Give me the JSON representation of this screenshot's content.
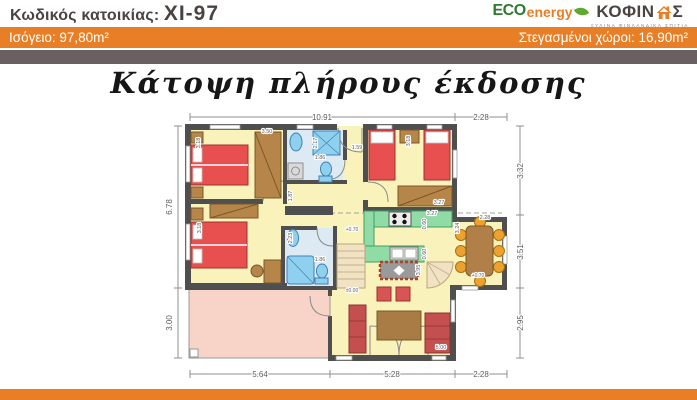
{
  "header": {
    "code_label": "Κωδικός κατοικίας:",
    "code_value": "XI-97",
    "logo": {
      "eco": "ECO",
      "energy": "energy",
      "brand_pre": "ΚΟΦΙΝ",
      "brand_post": "Σ",
      "tagline": "ΞΥΛΙΝΑ ΦΙΝΛΑΝΔΙΚΑ ΣΠΙΤΙΑ"
    },
    "area_bar": {
      "left": "Ισόγειο: 97,80m²",
      "right": "Στεγασμένοι χώροι: 16,90m²"
    }
  },
  "title": "Κάτοψη πλήρους έκδοσης",
  "colors": {
    "orange": "#E87E25",
    "dark_bar": "#6B6060",
    "wall": "#4F4F4F",
    "floor_yellow": "#F9F3BB",
    "bath_floor": "#DDE9F3",
    "terrace_pink": "#F7D3C8",
    "bed_red": "#E85050",
    "sofa_red": "#C44F4F",
    "wood_brown": "#B5854A",
    "counter_green": "#90DBA6",
    "fixture_blue": "#8FD0EF",
    "chair_orange": "#ECA22E",
    "stair_beige": "#F1E2C3"
  },
  "plan": {
    "labels": [
      {
        "t": "10.91",
        "x": 322,
        "y": 120,
        "s": 8
      },
      {
        "t": "2.28",
        "x": 481,
        "y": 120,
        "s": 8
      },
      {
        "t": "6.78",
        "x": 172,
        "y": 207,
        "r": -90,
        "s": 8
      },
      {
        "t": "3.00",
        "x": 172,
        "y": 323,
        "r": -90,
        "s": 8
      },
      {
        "t": "3.32",
        "x": 523,
        "y": 171,
        "r": -90,
        "s": 8
      },
      {
        "t": "3.51",
        "x": 523,
        "y": 252,
        "r": -90,
        "s": 8
      },
      {
        "t": "2.95",
        "x": 523,
        "y": 323,
        "r": -90,
        "s": 8
      },
      {
        "t": "5.64",
        "x": 260,
        "y": 377,
        "s": 8
      },
      {
        "t": "5.28",
        "x": 392,
        "y": 377,
        "s": 8
      },
      {
        "t": "2.28",
        "x": 481,
        "y": 377,
        "s": 8
      },
      {
        "t": "3.50",
        "x": 267,
        "y": 133
      },
      {
        "t": "3.18",
        "x": 200,
        "y": 143,
        "r": -90
      },
      {
        "t": "2.17",
        "x": 317,
        "y": 143,
        "r": -90
      },
      {
        "t": "1.86",
        "x": 320,
        "y": 159
      },
      {
        "t": "1.59",
        "x": 357,
        "y": 149
      },
      {
        "t": "3.18",
        "x": 410,
        "y": 141,
        "r": -90
      },
      {
        "t": "3.27",
        "x": 439,
        "y": 204
      },
      {
        "t": "1.87",
        "x": 292,
        "y": 196,
        "r": -90
      },
      {
        "t": "3.18",
        "x": 201,
        "y": 228,
        "r": -90
      },
      {
        "t": "2.23",
        "x": 292,
        "y": 238,
        "r": -90
      },
      {
        "t": "1.86",
        "x": 320,
        "y": 261
      },
      {
        "t": "3.27",
        "x": 432,
        "y": 215
      },
      {
        "t": "0.60",
        "x": 426,
        "y": 224,
        "r": -90
      },
      {
        "t": "0.60",
        "x": 426,
        "y": 254,
        "r": -90
      },
      {
        "t": "3.24",
        "x": 459,
        "y": 228,
        "r": -90
      },
      {
        "t": "2.28",
        "x": 485,
        "y": 219
      },
      {
        "t": "3.95",
        "x": 420,
        "y": 270,
        "r": -90
      },
      {
        "t": "+0.70",
        "x": 352,
        "y": 231,
        "s": 5
      },
      {
        "t": "+0.70",
        "x": 478,
        "y": 277,
        "s": 5
      },
      {
        "t": "±0.00",
        "x": 352,
        "y": 292,
        "s": 5
      },
      {
        "t": "5.00",
        "x": 441,
        "y": 349
      }
    ]
  }
}
